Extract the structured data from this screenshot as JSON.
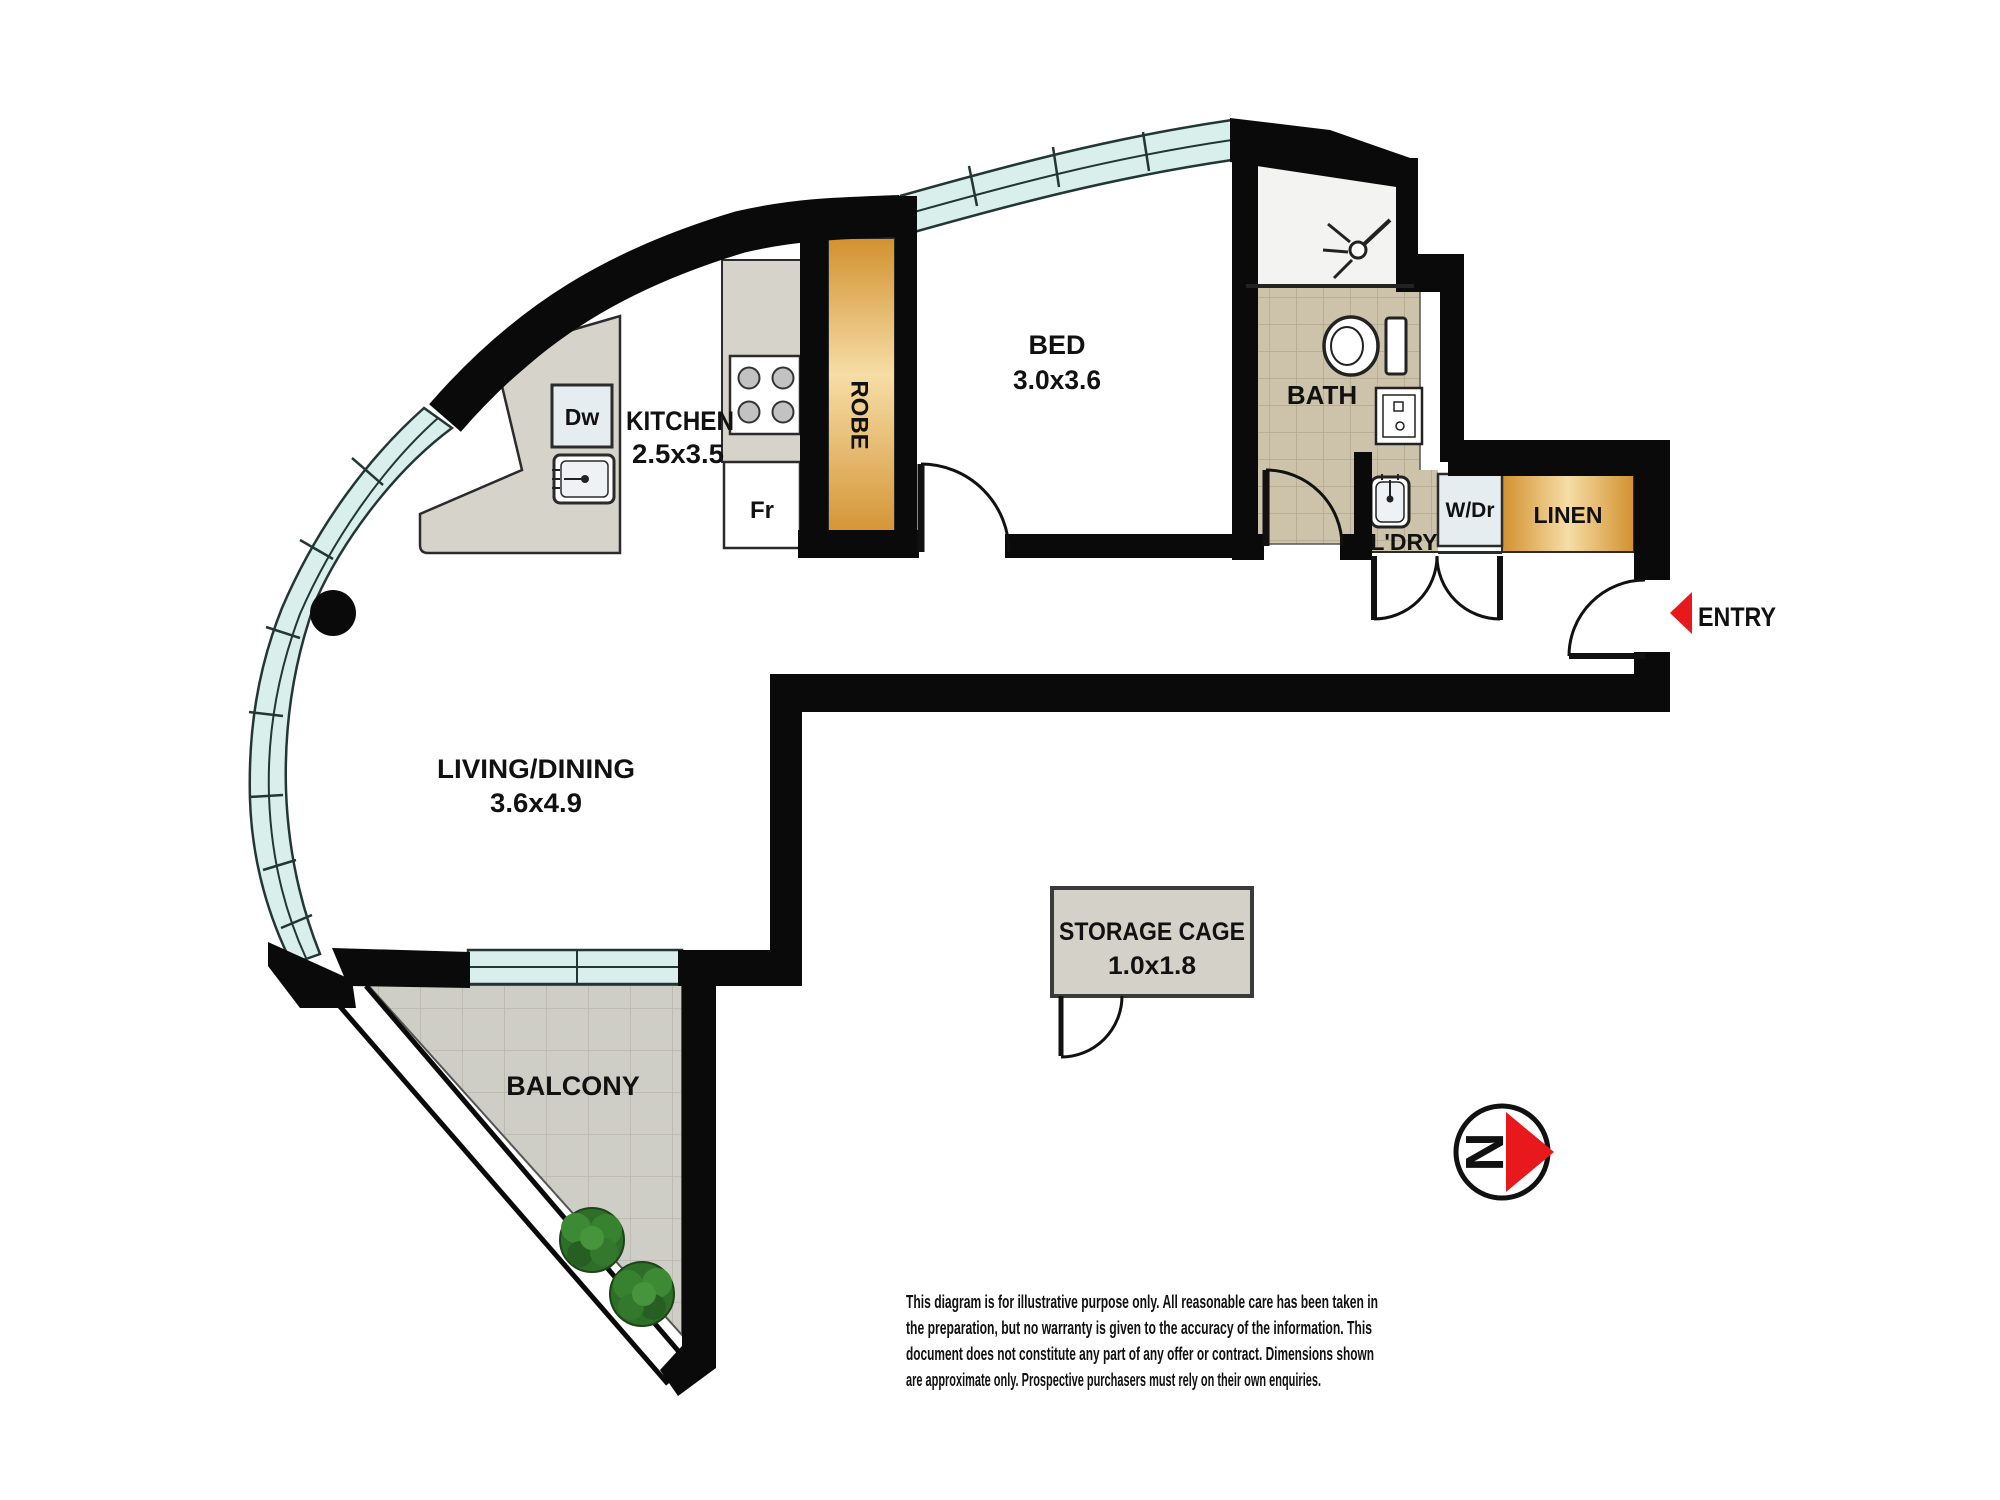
{
  "plan": {
    "rooms": {
      "kitchen": {
        "label": "KITCHEN",
        "dims": "2.5x3.5"
      },
      "bed": {
        "label": "BED",
        "dims": "3.0x3.6"
      },
      "bath": {
        "label": "BATH"
      },
      "living": {
        "label": "LIVING/DINING",
        "dims": "3.6x4.9"
      },
      "balcony": {
        "label": "BALCONY"
      },
      "laundry": {
        "label": "L'DRY"
      },
      "robe": {
        "label": "ROBE"
      },
      "linen": {
        "label": "LINEN"
      },
      "storage": {
        "label": "STORAGE CAGE",
        "dims": "1.0x1.8"
      }
    },
    "fixtures": {
      "dishwasher": "Dw",
      "fridge": "Fr",
      "washer_dryer": "W/Dr"
    },
    "entry": {
      "label": "ENTRY"
    },
    "compass": {
      "label": "N"
    },
    "colors": {
      "wall": "#0a0a0a",
      "glass": "#d9efec",
      "glass_edge": "#223734",
      "bath_tile": "#cdc3ab",
      "bath_tile_line": "#b2a78c",
      "balcony_tile": "#cfcec6",
      "balcony_tile_line": "#b8b7ac",
      "counter": "#d6d4ca",
      "cabinet_orange_dark": "#d2912f",
      "cabinet_orange_light": "#f6dda6",
      "fixture_blue_white": "#e6edf0",
      "storage_fill": "#d4d2c8",
      "accent_red": "#e8191c",
      "tree_green": "#2e6f28"
    }
  },
  "disclaimer": {
    "lines": [
      "This diagram is for illustrative purpose only. All reasonable care has been taken in",
      "the preparation, but no warranty is given to the accuracy of the information. This",
      "document does not constitute any part of any offer or contract. Dimensions shown",
      "are approximate only. Prospective purchasers must rely on their own enquiries."
    ]
  }
}
